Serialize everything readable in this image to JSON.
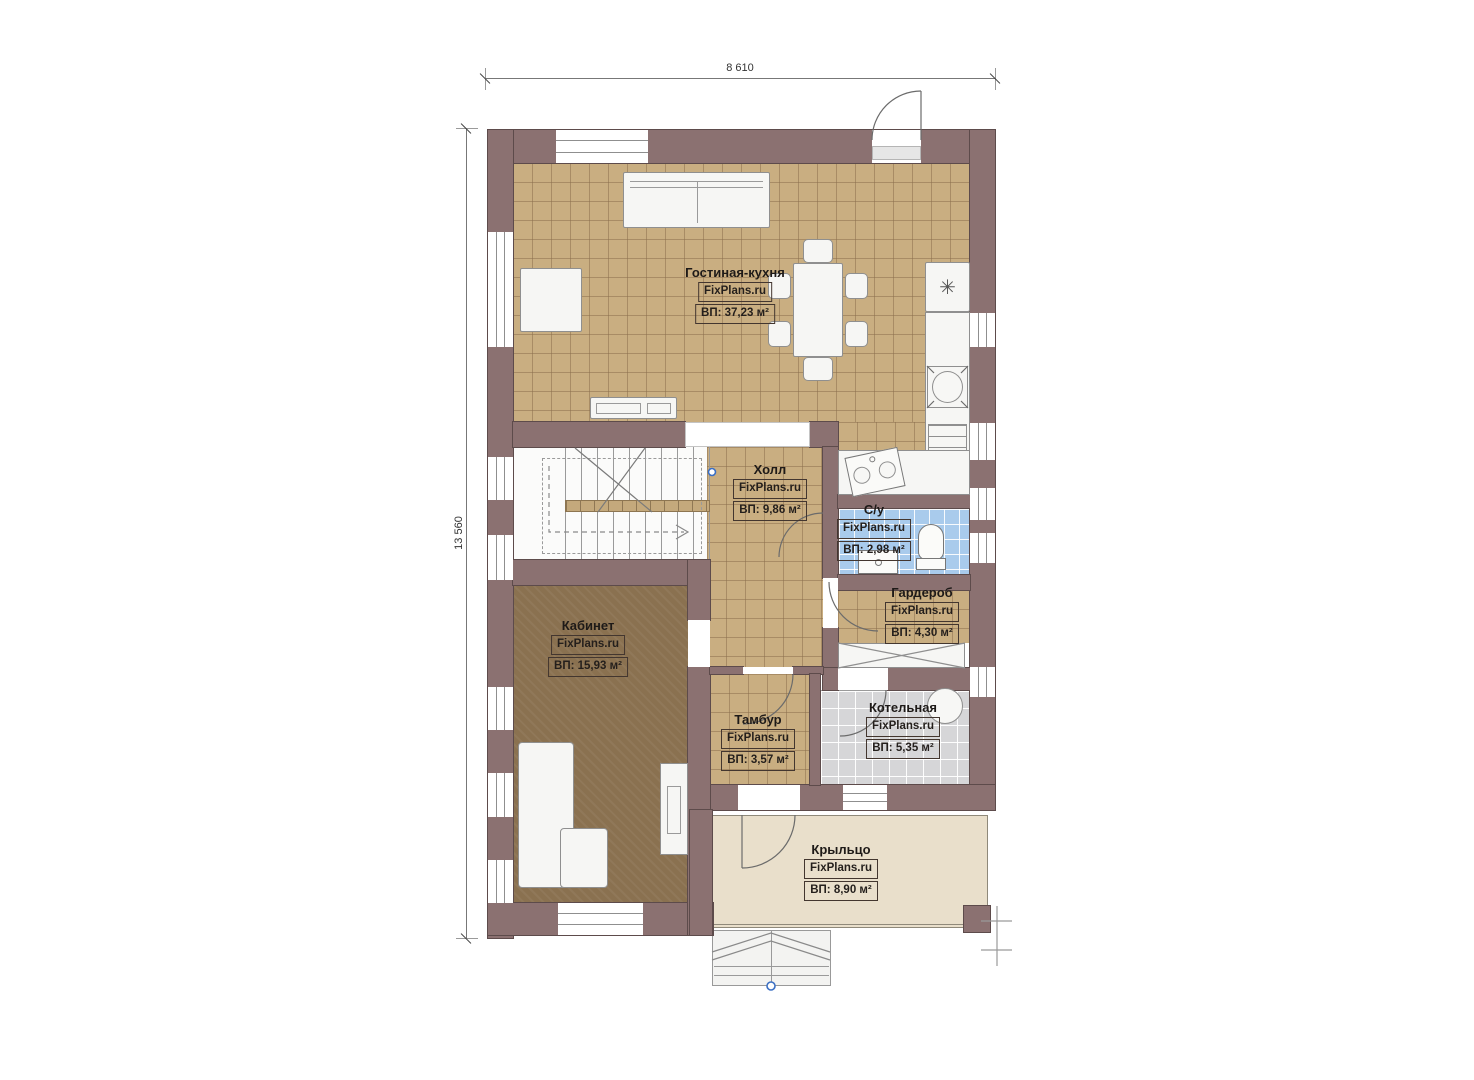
{
  "drawing_title": "План 1 этажа",
  "dimensions": {
    "width_label": "8 610",
    "height_label": "13 560"
  },
  "rooms": [
    {
      "name": "Гостиная-кухня",
      "watermark": "FixPlans.ru",
      "area": "ВП: 37,23 м²"
    },
    {
      "name": "Холл",
      "watermark": "FixPlans.ru",
      "area": "ВП: 9,86 м²"
    },
    {
      "name": "С/у",
      "watermark": "FixPlans.ru",
      "area": "ВП: 2,98 м²"
    },
    {
      "name": "Гардероб",
      "watermark": "FixPlans.ru",
      "area": "ВП: 4,30 м²"
    },
    {
      "name": "Кабинет",
      "watermark": "FixPlans.ru",
      "area": "ВП: 15,93 м²"
    },
    {
      "name": "Тамбур",
      "watermark": "FixPlans.ru",
      "area": "ВП: 3,57 м²"
    },
    {
      "name": "Котельная",
      "watermark": "FixPlans.ru",
      "area": "ВП: 5,35 м²"
    },
    {
      "name": "Крыльцо",
      "watermark": "FixPlans.ru",
      "area": "ВП: 8,90 м²"
    }
  ],
  "icons": {
    "stove_symbol": "✳"
  },
  "colors": {
    "wall": "#8b7171",
    "floor_tile": "#c9ae81",
    "office_floor": "#8a7150",
    "bathroom_tile": "#a9cbec",
    "boiler_tile": "#d6d6d8",
    "porch_floor": "#e9dfcb",
    "marker_blue": "#3a6fc4"
  }
}
